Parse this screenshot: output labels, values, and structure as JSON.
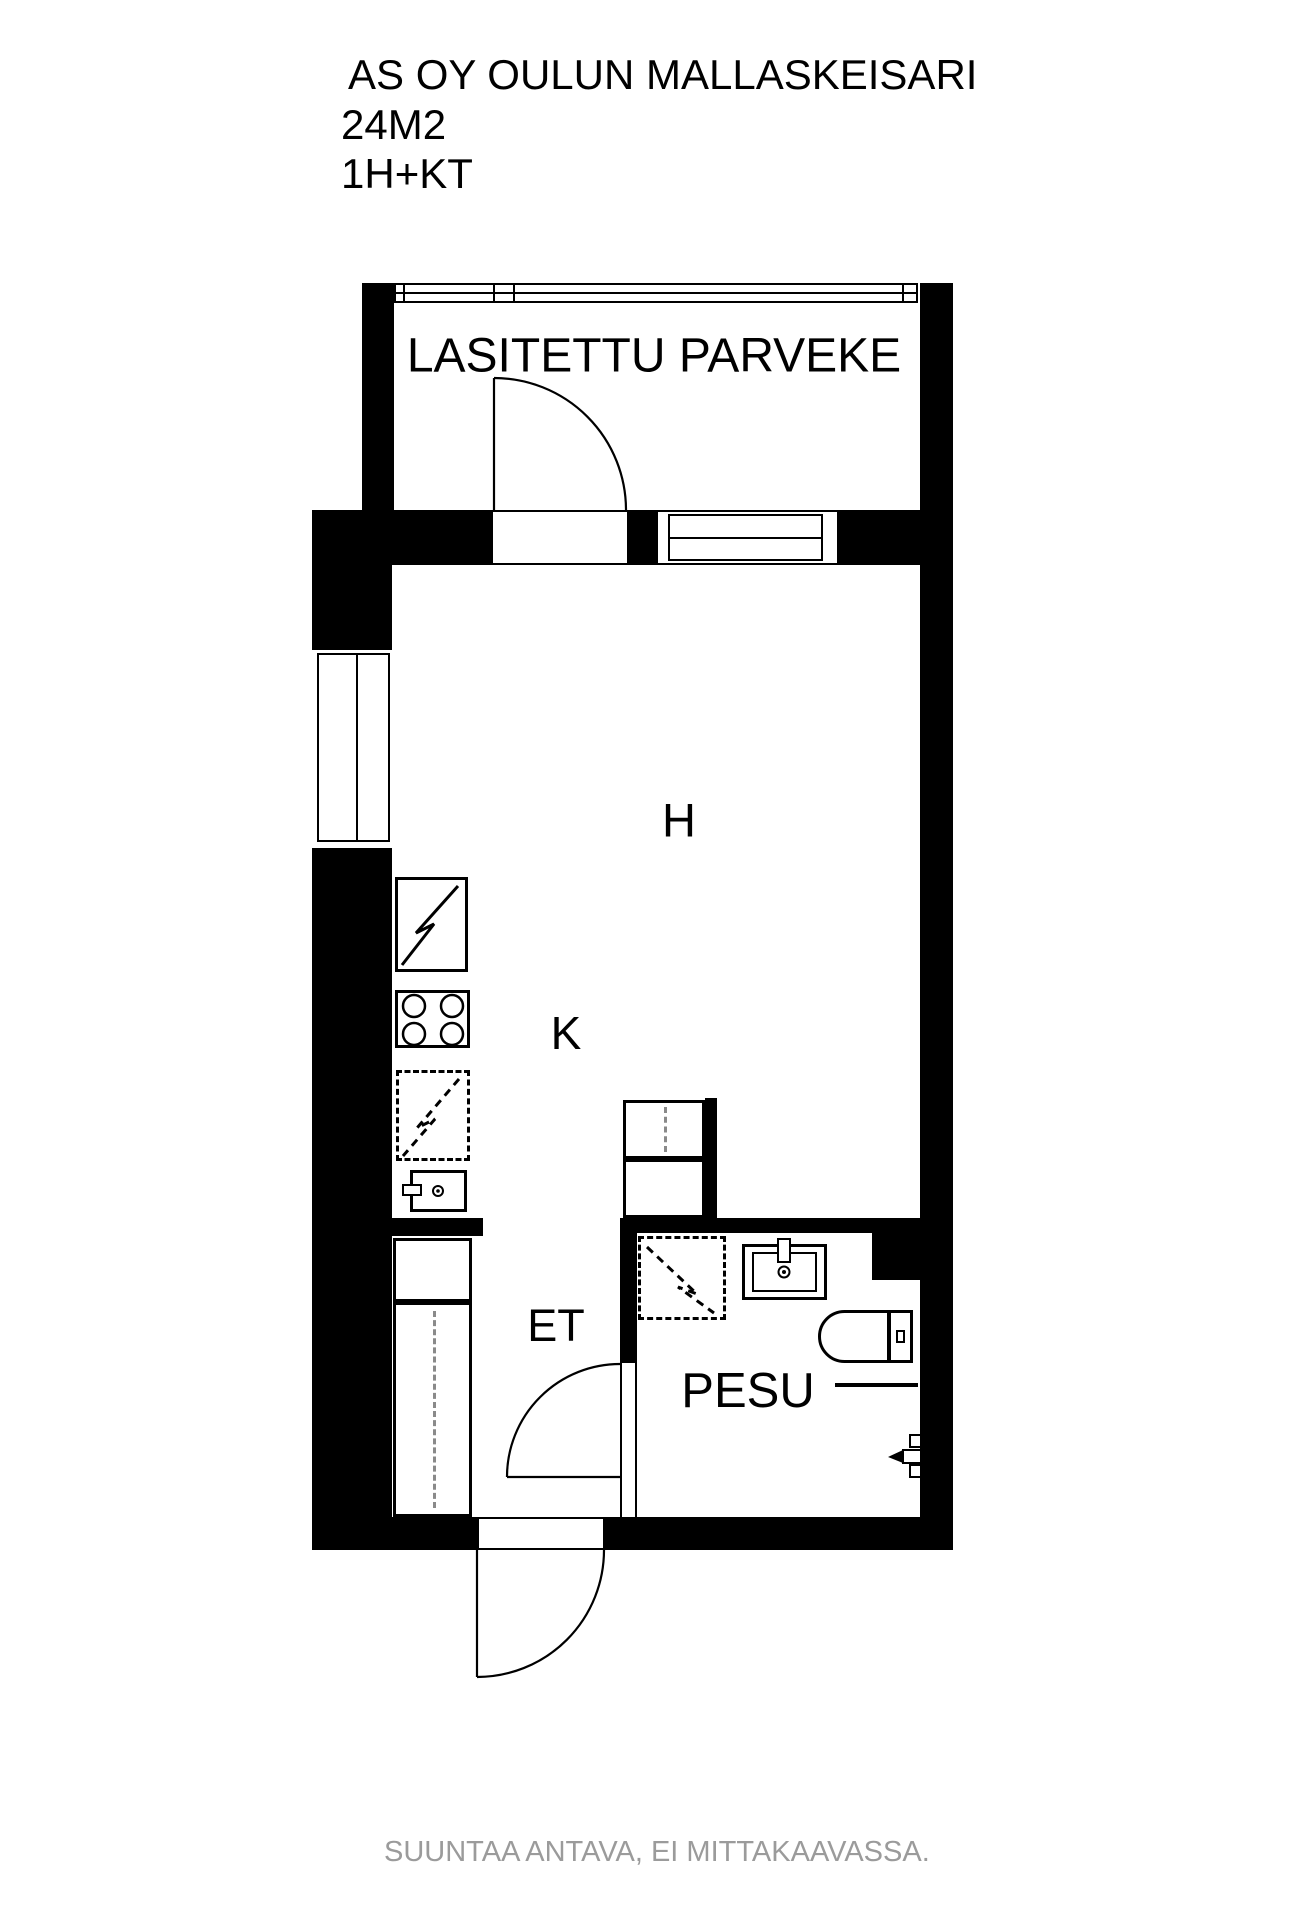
{
  "title": {
    "line1": "AS OY OULUN MALLASKEISARI",
    "line2": "24M2",
    "line3": "1H+KT"
  },
  "rooms": {
    "balcony_label": "LASITETTU PARVEKE",
    "living_label": "H",
    "kitchen_label": "K",
    "entry_label": "ET",
    "bathroom_label": "PESU"
  },
  "footer": {
    "disclaimer": "SUUNTAA ANTAVA, EI MITTAKAAVASSA."
  },
  "colors": {
    "wall": "#000000",
    "line": "#000000",
    "background": "#ffffff",
    "footer_text": "#9b9b9b",
    "reservation_dash": "#8a8a8a"
  },
  "icons": {
    "fridge": "lightning-bolt-icon",
    "stove": "four-burner-icon",
    "dishwasher_reservation": "dashed-lightning-bolt-icon",
    "washer_reservation": "dashed-lightning-bolt-icon"
  }
}
